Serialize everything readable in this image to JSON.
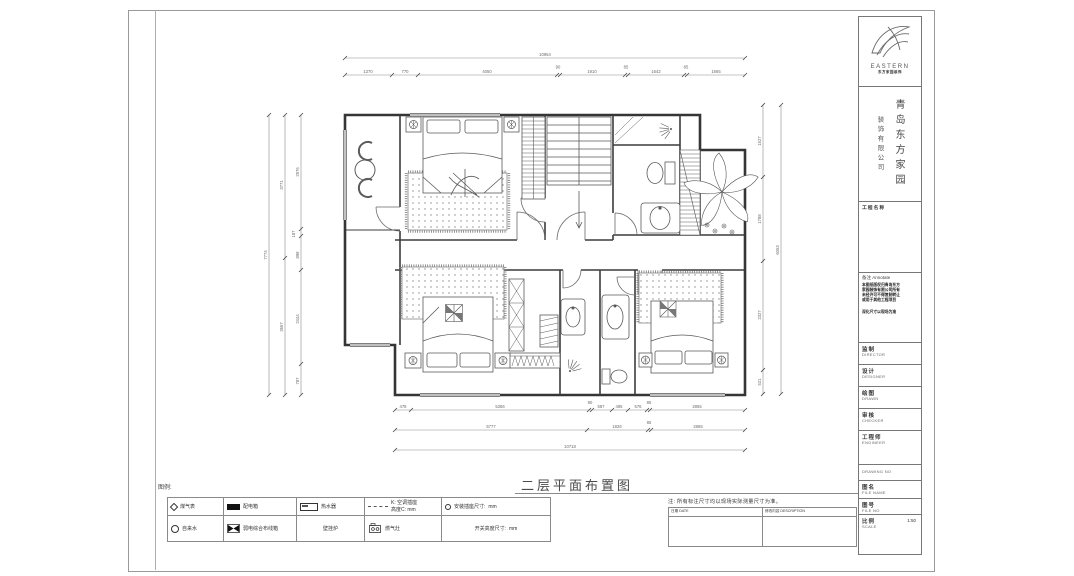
{
  "drawing": {
    "title": "二层平面布置图"
  },
  "legend": {
    "label": "图例:",
    "r1": [
      {
        "name": "gas-meter",
        "label": "煤气表"
      },
      {
        "name": "distribution-box",
        "label": "配电箱"
      },
      {
        "name": "water-heater",
        "label": "热水器"
      },
      {
        "name": "ac-socket",
        "label": "K: 空调插座",
        "label2": "高度C: mm"
      },
      {
        "name": "socket-size",
        "label": "安装插座尺寸:",
        "unit": "mm"
      }
    ],
    "r2": [
      {
        "name": "water-meter",
        "label": "自来水"
      },
      {
        "name": "lv-wiring-box",
        "label": "弱电综合布线箱"
      },
      {
        "name": "wall-boiler",
        "label": "壁挂炉"
      },
      {
        "name": "gas-stove",
        "label": "燃气灶"
      },
      {
        "name": "switch-height",
        "label": "开关高度尺寸:",
        "unit": "mm"
      }
    ]
  },
  "note": "注: 所有标注尺寸均以现场实际测量尺寸为准。",
  "revision": {
    "col1": "日期 DATE",
    "col2": "修改内容 DESCRIPTION"
  },
  "dims": {
    "top_total": "10954",
    "top": [
      "1370",
      "770",
      "4050",
      "90",
      "1910",
      "85",
      "1642",
      "85",
      "1665"
    ],
    "left_outer": "7774",
    "left_mid": [
      "3771",
      "3667"
    ],
    "left_inner": [
      "2976",
      "187",
      "898",
      "2444",
      "787"
    ],
    "right_inner": [
      "1527",
      "1788",
      "2327",
      "521"
    ],
    "right_outer": "6063",
    "bottom_r1": [
      "478",
      "5356",
      "90",
      "587",
      "495",
      "576",
      "85",
      "2865"
    ],
    "bottom_r2": [
      "5777",
      "1826",
      "85",
      "2865"
    ],
    "bottom_total": "10718"
  },
  "titleblock": {
    "logo_text": "EASTERN",
    "logo_sub": "东方家园装饰",
    "company_main": "青岛东方家园",
    "company_sub": "装饰有限公司",
    "project_label": "工程名称",
    "annotate": {
      "cn": "备注",
      "en": "Annotate",
      "lines": [
        "本图纸版权归青岛东方",
        "家园装饰有限公司所有",
        "未经许可不得复制转让",
        "或用于其他工程项目"
      ],
      "footer": "深化尺寸以现场为准"
    },
    "rows": [
      {
        "cn": "监制",
        "en": "DIRECTOR"
      },
      {
        "cn": "设计",
        "en": "DESIGNER"
      },
      {
        "cn": "绘图",
        "en": "DRAWN"
      },
      {
        "cn": "审核",
        "en": "CHECKER"
      },
      {
        "cn": "工程师",
        "en": "ENGINEER"
      },
      {
        "cn": "",
        "en": "DRAWING NO"
      },
      {
        "cn": "图名",
        "en": "FILE NAME"
      },
      {
        "cn": "图号",
        "en": "FILE NO"
      },
      {
        "cn": "比例",
        "en": "SCALE",
        "value": "1:50"
      }
    ]
  }
}
